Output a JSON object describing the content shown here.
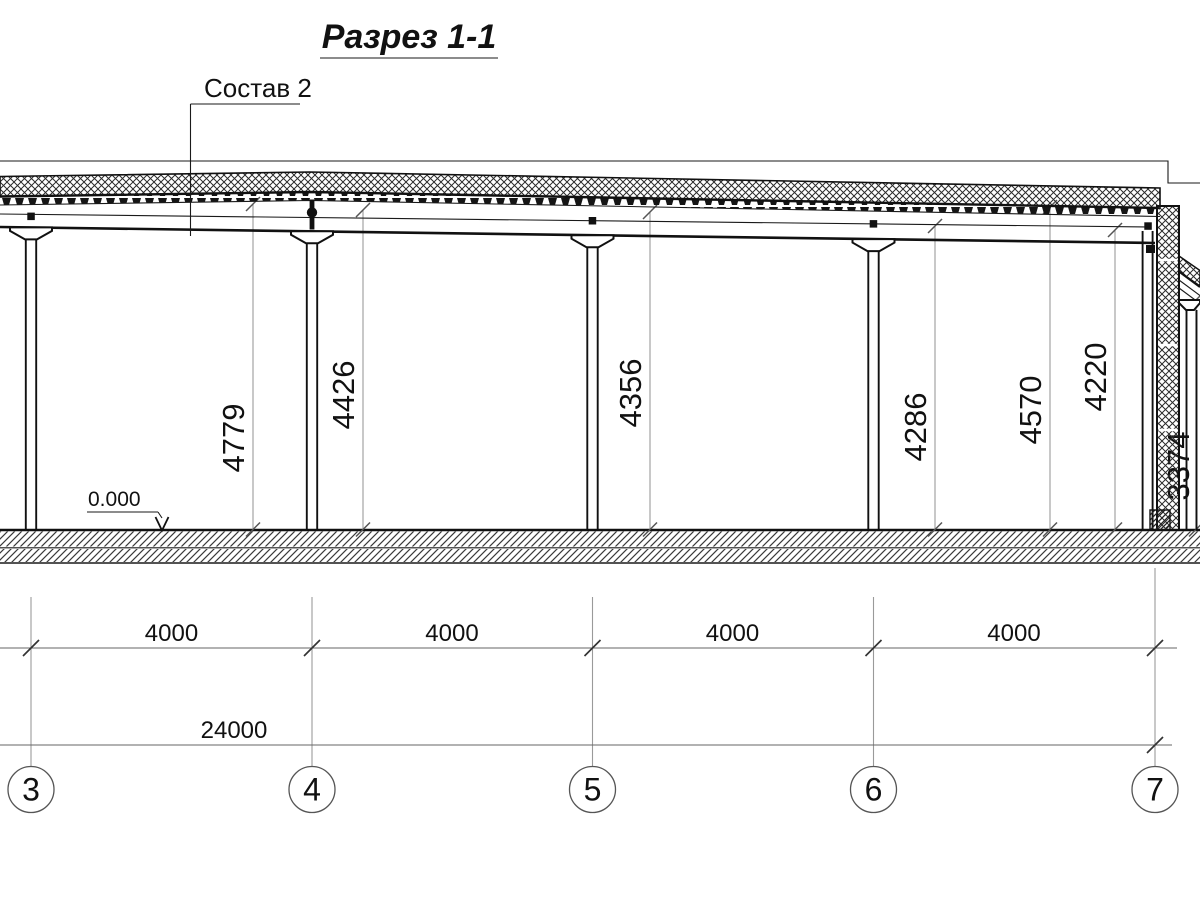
{
  "drawing": {
    "title": "Разрез 1-1",
    "callout": "Состав 2",
    "level_mark": "0.000"
  },
  "vertical_dimensions": [
    "4779",
    "4426",
    "4356",
    "4286",
    "4570",
    "4220",
    "3374"
  ],
  "bay_dimensions": [
    "4000",
    "4000",
    "4000",
    "4000"
  ],
  "overall_dimension": "24000",
  "grid_axes": [
    "3",
    "4",
    "5",
    "6",
    "7"
  ],
  "colors": {
    "line": "#1a1a1a",
    "dimension_line": "#9a9a9a",
    "background": "#ffffff"
  }
}
